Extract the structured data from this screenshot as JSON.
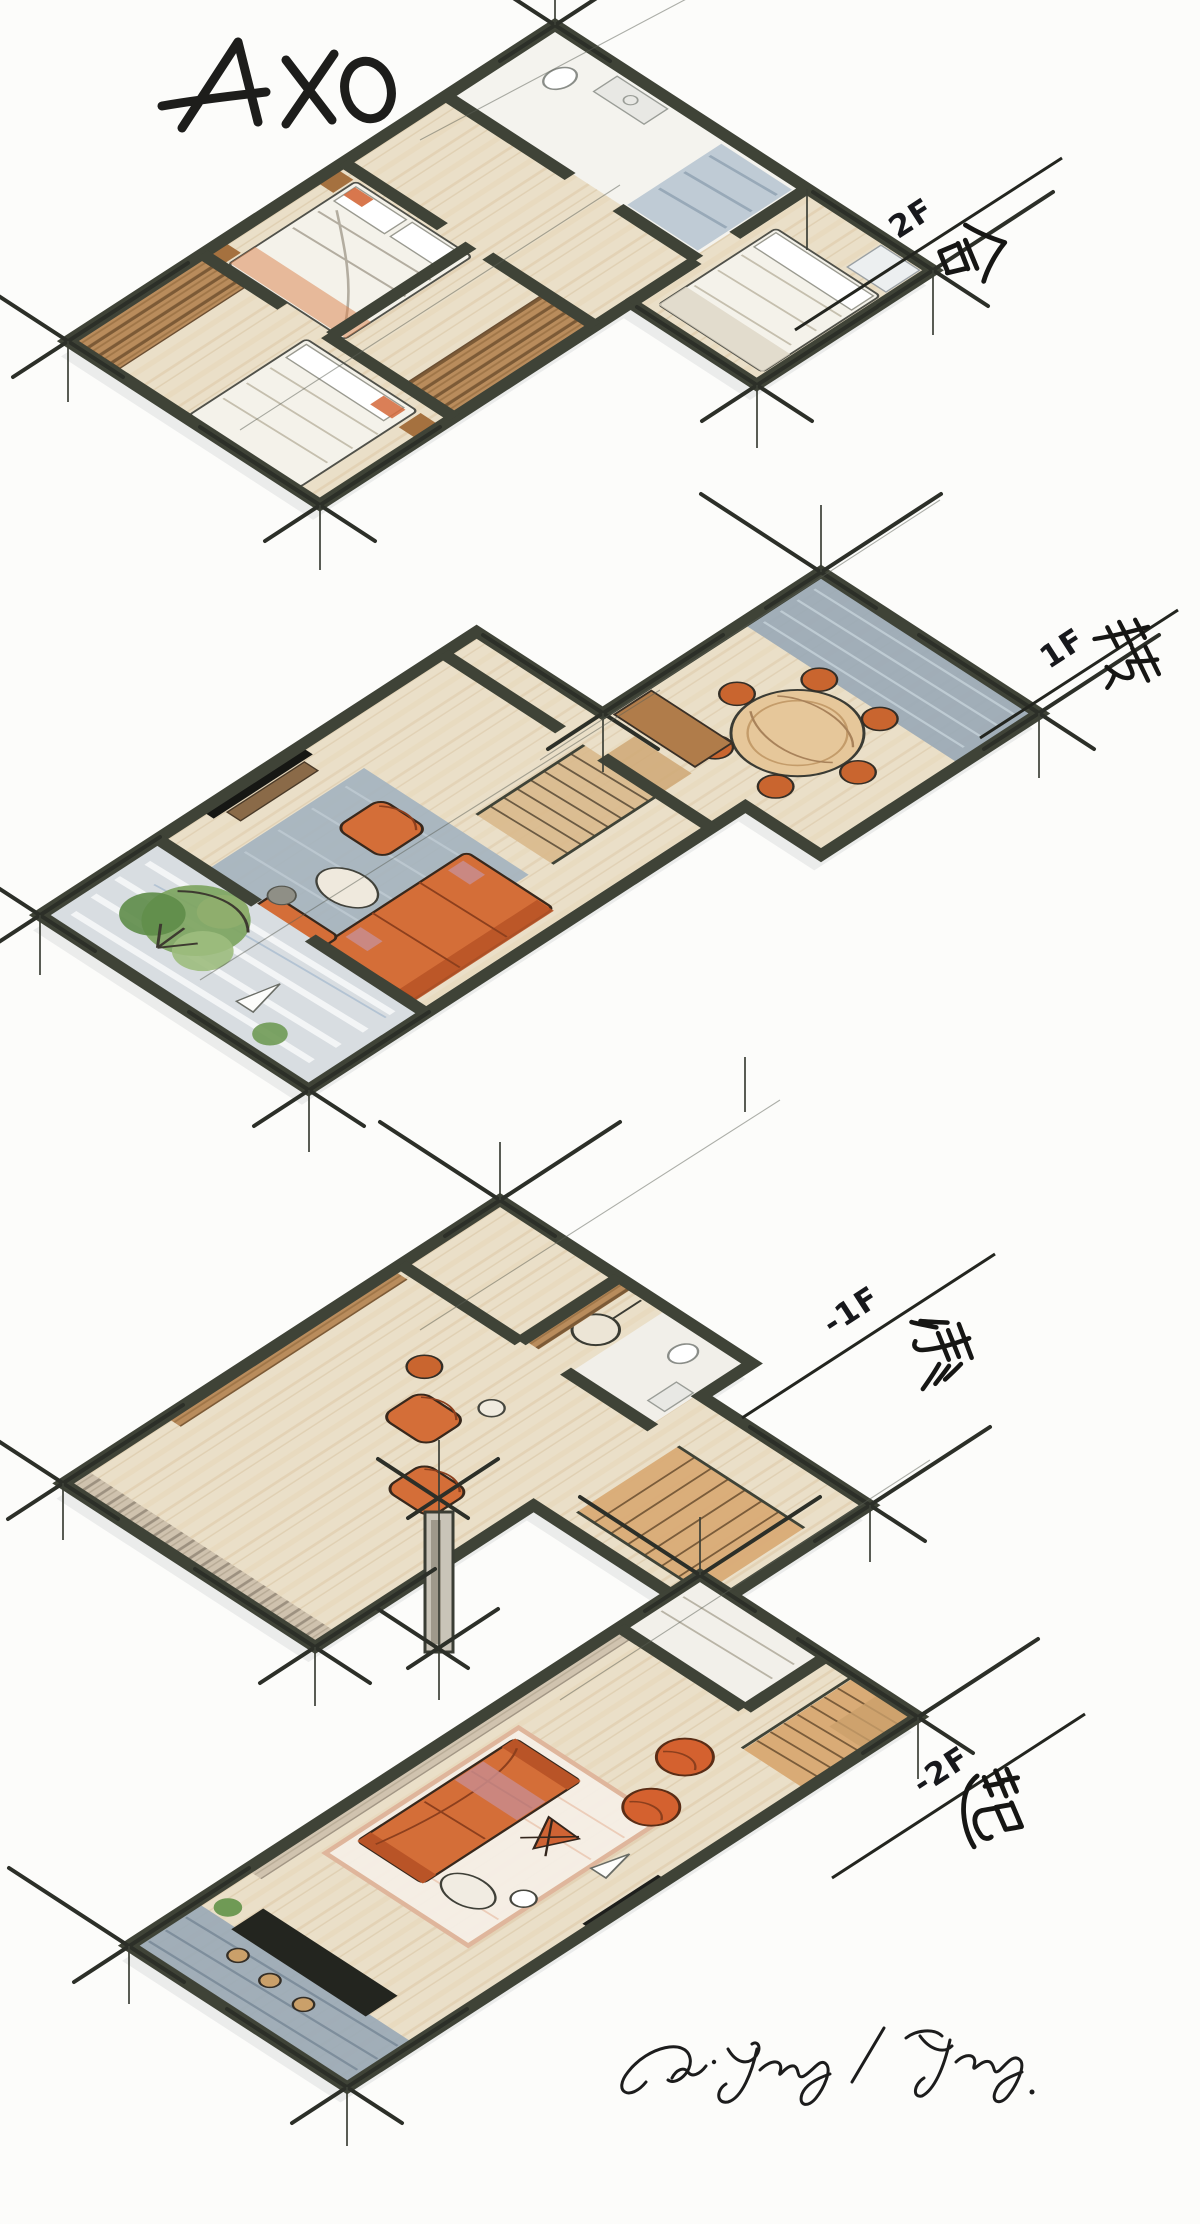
{
  "drawing": {
    "title": "AXO",
    "signature": "Ou·Yang / Yang."
  },
  "floors": [
    {
      "id": "2f",
      "level_label": "2F",
      "concept_char": "合"
    },
    {
      "id": "1f",
      "level_label": "1F",
      "concept_char": "转"
    },
    {
      "id": "b1f",
      "level_label": "-1F",
      "concept_char": "承"
    },
    {
      "id": "b2f",
      "level_label": "-2F",
      "concept_char": "起"
    }
  ],
  "palette": {
    "paper": "#fcfcfa",
    "ink": "#1d1d1b",
    "wall": "#3f4337",
    "wood": "#eadfc8",
    "wood_deep": "#d9b98c",
    "orange": "#d46e38",
    "orange_deep": "#b9531f",
    "blue_gray": "#9aa9b6",
    "rug_blue": "#a3b2bf",
    "courtyard": "#d8dde1",
    "green": "#7fa563",
    "bed_white": "#f4f2ea"
  }
}
